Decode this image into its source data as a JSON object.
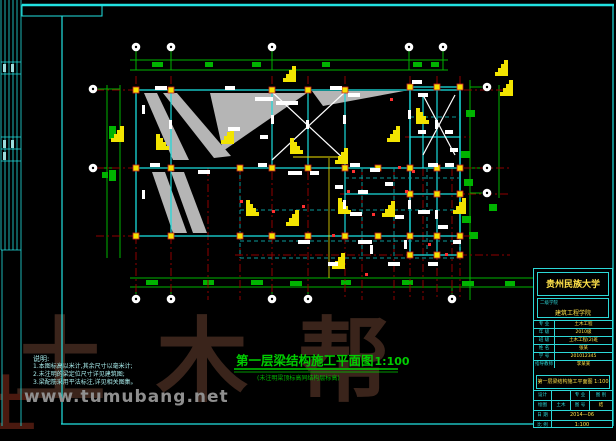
{
  "colors": {
    "background": "#000000",
    "frame": "#22e2e2",
    "grid_green": "#00b400",
    "axis_red": "#8f0000",
    "highlight_red": "#ff3030",
    "annotation_yellow": "#f2e400",
    "beam_cyan": "#19dcdc",
    "beam_teal": "#0a9a9a",
    "slab_gray": "#b5b5b5",
    "text_white": "#ffffff",
    "title_green": "#00cc00",
    "titleblock_yellow": "#ffe24a",
    "titleblock_cyan": "#2cd8d8",
    "watermark_brown": "#3a241b",
    "watermark_gray": "#8f8f8f"
  },
  "main_title": {
    "text": "第一层梁结构施工平面图",
    "scale": "1:100",
    "subtitle": "(未注明梁顶标高同结构层标高)"
  },
  "notes": {
    "header": "说明:",
    "items": [
      "1.本图标高以米计,其余尺寸以毫米计;",
      "2.未注明的梁定位尺寸详见建筑图;",
      "3.梁配筋采用平法标注,详见相关图集。"
    ]
  },
  "title_block": {
    "university": "贵州民族大学",
    "college_label": "二级学院",
    "college": "建筑工程学院",
    "rows": [
      {
        "label": "专 业",
        "value": "土木工程"
      },
      {
        "label": "年 级",
        "value": "2010级"
      },
      {
        "label": "班 级",
        "value": "土木工程(2)班"
      },
      {
        "label": "姓 名",
        "value": "张某"
      },
      {
        "label": "学 号",
        "value": "201012345"
      },
      {
        "label": "指导教师",
        "value": "李某某"
      }
    ],
    "drawing_title": "第一层梁结构施工平面图 1:100",
    "grid": {
      "row1": [
        "设计",
        "",
        "专 业",
        "图 别"
      ],
      "row2": [
        "绘图",
        "土木",
        "图 号",
        "结"
      ],
      "date_label": "日 期",
      "date_value": "2014—06",
      "scale_label": "比 例",
      "scale_value": "1:100"
    }
  },
  "watermark": {
    "brand": "土木帮",
    "site": "www.tumubang.net",
    "corner": "土"
  }
}
